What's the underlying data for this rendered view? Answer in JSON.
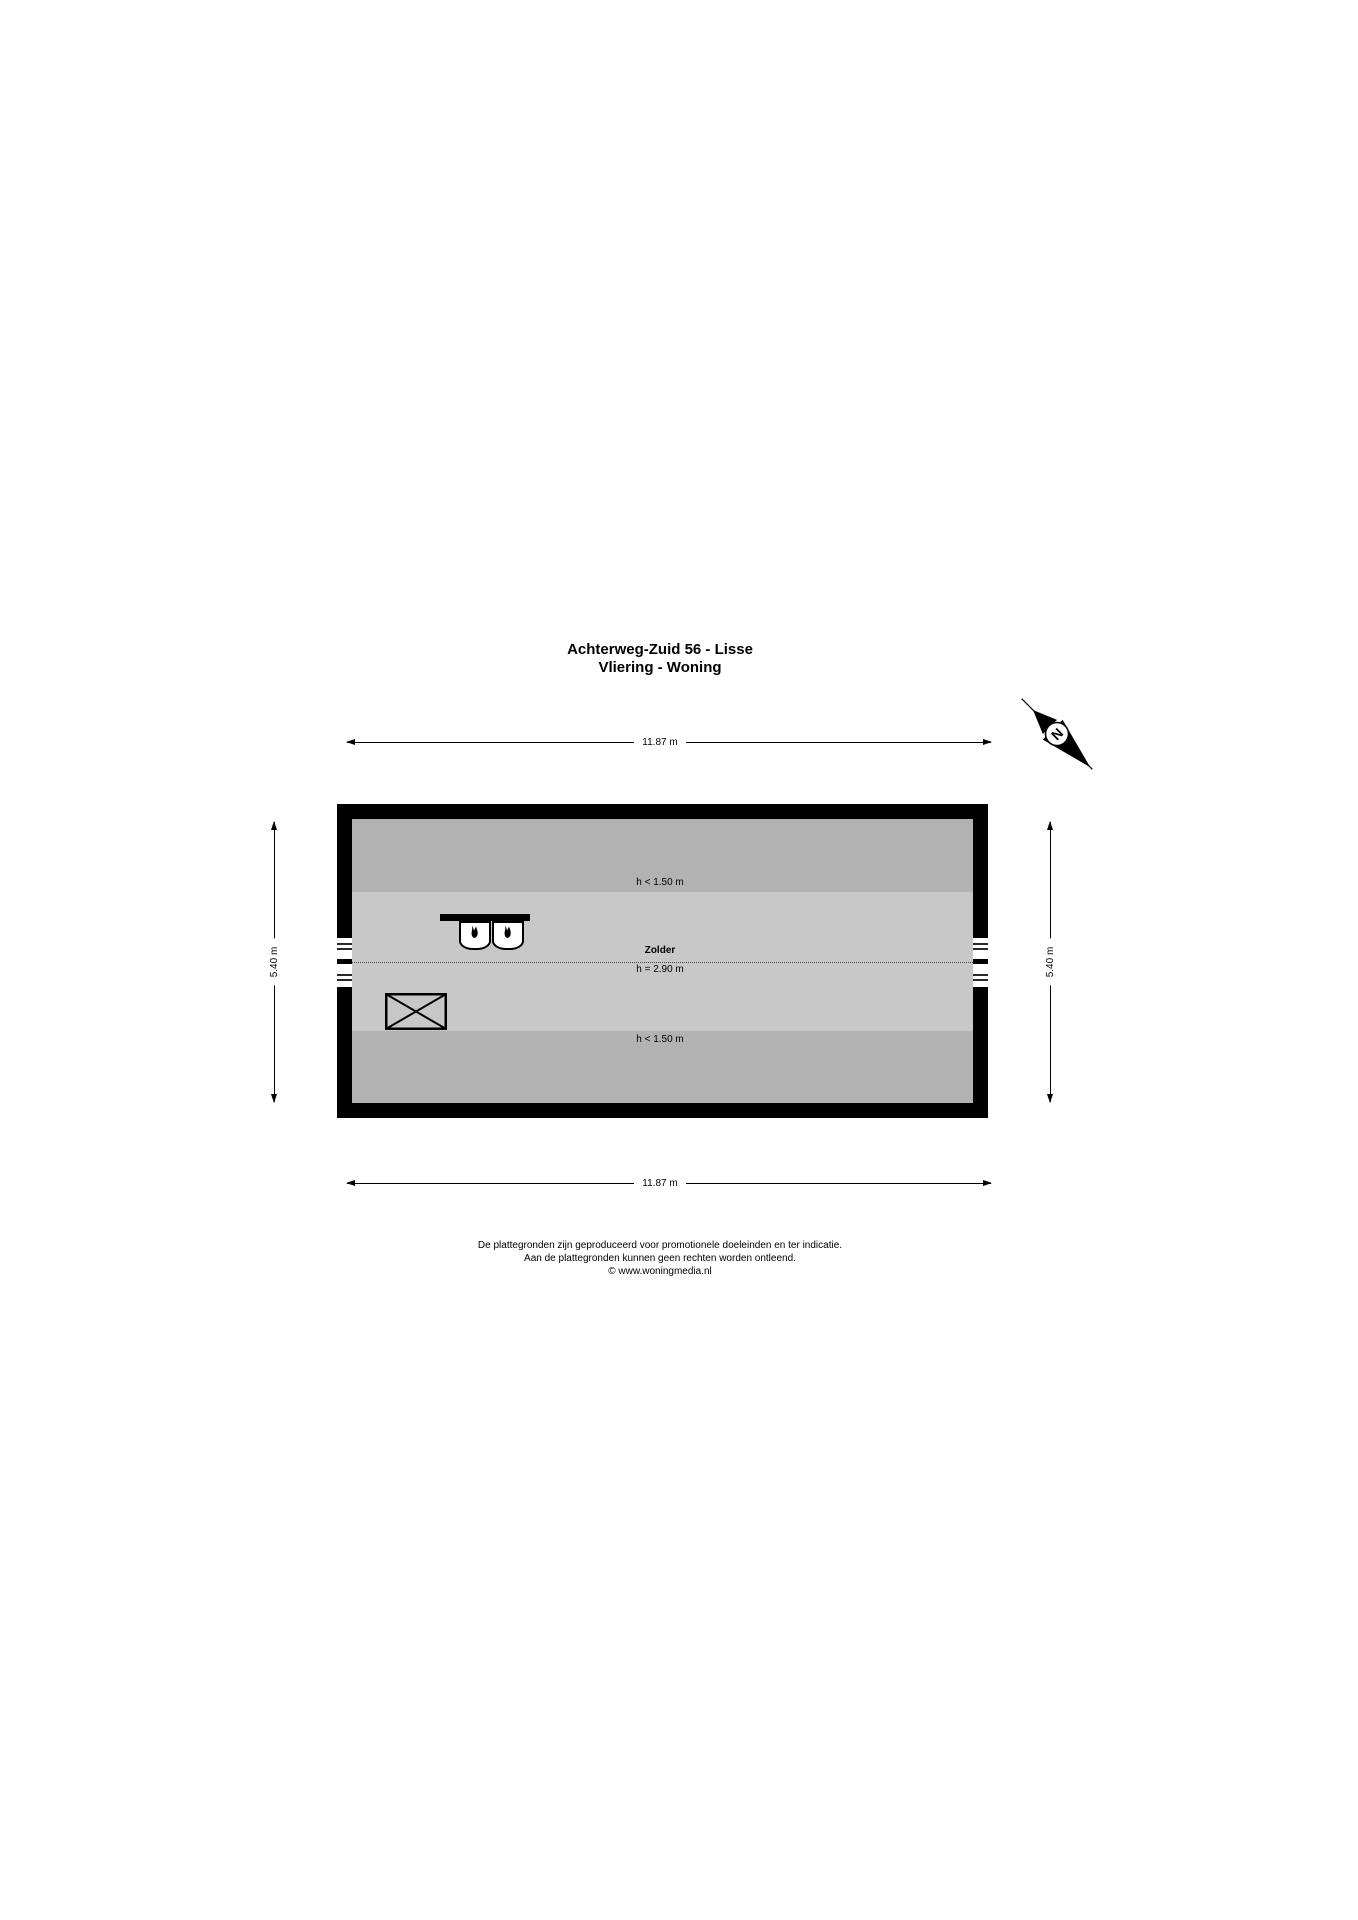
{
  "title": {
    "line1": "Achterweg-Zuid 56 - Lisse",
    "line2": "Vliering - Woning"
  },
  "compass": {
    "north_label": "N"
  },
  "dimensions": {
    "top": "11.87 m",
    "bottom": "11.87 m",
    "left": "5.40 m",
    "right": "5.40 m"
  },
  "plan": {
    "room_name": "Zolder",
    "room_height": "h = 2.90 m",
    "low_zone_top": "h < 1.50 m",
    "low_zone_bottom": "h < 1.50 m"
  },
  "colors": {
    "wall": "#000000",
    "zone_low": "#b2b2b2",
    "zone_main": "#c8c8c8",
    "background": "#ffffff"
  },
  "footer": {
    "line1": "De plattegronden zijn geproduceerd voor promotionele doeleinden en ter indicatie.",
    "line2": "Aan de plattegronden kunnen geen rechten worden ontleend.",
    "line3": "© www.woningmedia.nl"
  }
}
